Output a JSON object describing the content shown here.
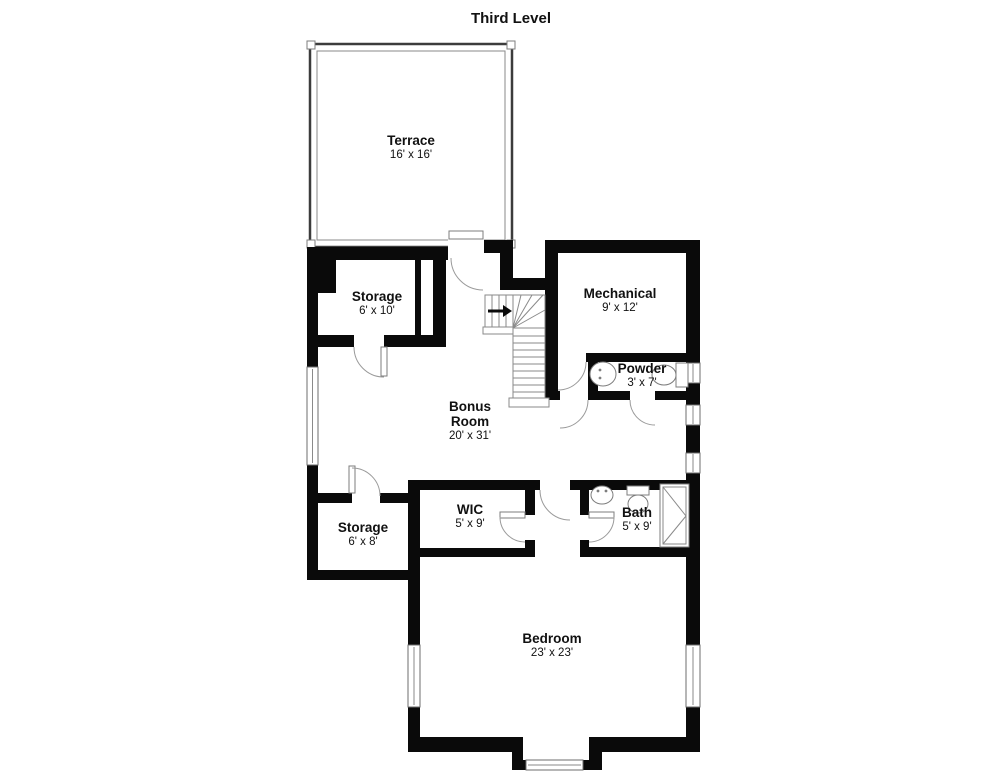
{
  "title": "Third Level",
  "rooms": {
    "terrace": {
      "name": "Terrace",
      "dims": "16' x 16'"
    },
    "storage_upper": {
      "name": "Storage",
      "dims": "6' x 10'"
    },
    "mechanical": {
      "name": "Mechanical",
      "dims": "9' x 12'"
    },
    "powder": {
      "name": "Powder",
      "dims": "3' x 7'"
    },
    "bonus": {
      "name": "Bonus Room",
      "dims": "20' x 31'"
    },
    "storage_lower": {
      "name": "Storage",
      "dims": "6' x 8'"
    },
    "wic": {
      "name": "WIC",
      "dims": "5' x 9'"
    },
    "bath": {
      "name": "Bath",
      "dims": "5' x 9'"
    },
    "bedroom": {
      "name": "Bedroom",
      "dims": "23' x 23'"
    }
  },
  "colors": {
    "wall": "#0a0a0a",
    "thin_line": "#8a8a8a",
    "background": "#ffffff",
    "text": "#111111"
  }
}
